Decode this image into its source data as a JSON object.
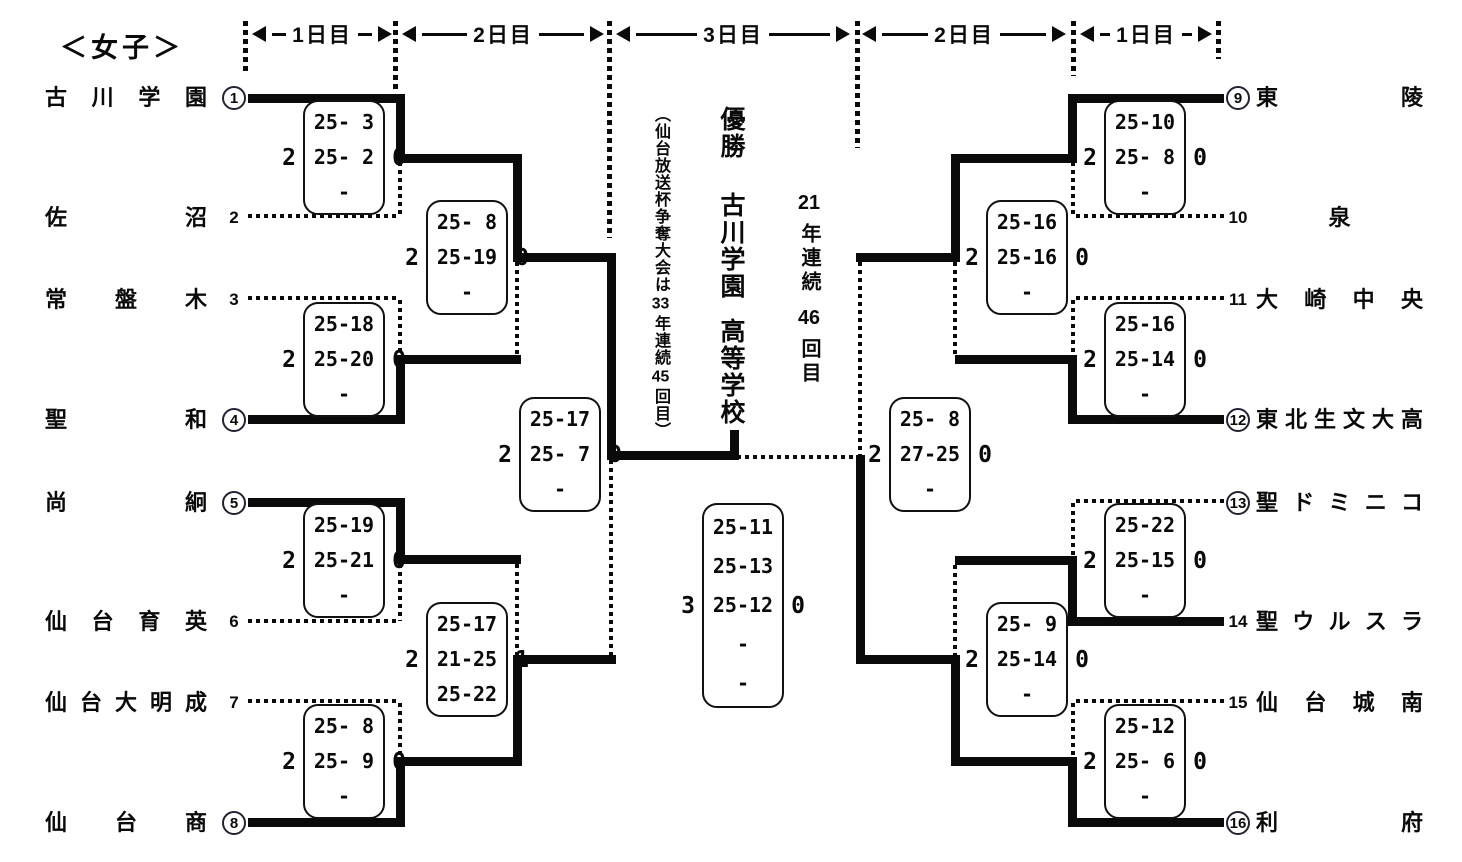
{
  "title": "＜女子＞",
  "headers": [
    "1日目",
    "2日目",
    "3日目",
    "2日目",
    "1日目"
  ],
  "teams_left": [
    {
      "seed": "1",
      "circled": true,
      "name": "古川学園"
    },
    {
      "seed": "2",
      "circled": false,
      "name": "佐沼"
    },
    {
      "seed": "3",
      "circled": false,
      "name": "常盤木"
    },
    {
      "seed": "4",
      "circled": true,
      "name": "聖和"
    },
    {
      "seed": "5",
      "circled": true,
      "name": "尚絅"
    },
    {
      "seed": "6",
      "circled": false,
      "name": "仙台育英"
    },
    {
      "seed": "7",
      "circled": false,
      "name": "仙台大明成"
    },
    {
      "seed": "8",
      "circled": true,
      "name": "仙台商"
    }
  ],
  "teams_right": [
    {
      "seed": "9",
      "circled": true,
      "name": "東陵"
    },
    {
      "seed": "10",
      "circled": false,
      "name": "泉"
    },
    {
      "seed": "11",
      "circled": false,
      "name": "大崎中央"
    },
    {
      "seed": "12",
      "circled": true,
      "name": "東北生文大高"
    },
    {
      "seed": "13",
      "circled": true,
      "name": "聖ドミニコ"
    },
    {
      "seed": "14",
      "circled": false,
      "name": "聖ウルスラ"
    },
    {
      "seed": "15",
      "circled": false,
      "name": "仙台城南"
    },
    {
      "seed": "16",
      "circled": true,
      "name": "利府"
    }
  ],
  "scores": {
    "r1_left": [
      {
        "w": "2",
        "l": "0",
        "sets": [
          "25- 3",
          "25- 2",
          "-"
        ]
      },
      {
        "w": "2",
        "l": "0",
        "sets": [
          "25-18",
          "25-20",
          "-"
        ]
      },
      {
        "w": "2",
        "l": "0",
        "sets": [
          "25-19",
          "25-21",
          "-"
        ]
      },
      {
        "w": "2",
        "l": "0",
        "sets": [
          "25- 8",
          "25- 9",
          "-"
        ]
      }
    ],
    "d2_left": [
      {
        "w": "2",
        "l": "0",
        "sets": [
          "25- 8",
          "25-19",
          "-"
        ]
      },
      {
        "w": "2",
        "l": "1",
        "sets": [
          "25-17",
          "21-25",
          "25-22"
        ]
      }
    ],
    "sf_left": {
      "w": "2",
      "l": "0",
      "sets": [
        "25-17",
        "25- 7",
        "-"
      ]
    },
    "final": {
      "w": "3",
      "l": "0",
      "sets": [
        "25-11",
        "25-13",
        "25-12",
        "-",
        "-"
      ]
    },
    "sf_right": {
      "w": "2",
      "l": "0",
      "sets": [
        "25- 8",
        "27-25",
        "-"
      ]
    },
    "d2_right": [
      {
        "w": "2",
        "l": "0",
        "sets": [
          "25-16",
          "25-16",
          "-"
        ]
      },
      {
        "w": "2",
        "l": "0",
        "sets": [
          "25- 9",
          "25-14",
          "-"
        ]
      }
    ],
    "r1_right": [
      {
        "w": "2",
        "l": "0",
        "sets": [
          "25-10",
          "25- 8",
          "-"
        ]
      },
      {
        "w": "2",
        "l": "0",
        "sets": [
          "25-16",
          "25-14",
          "-"
        ]
      },
      {
        "w": "2",
        "l": "0",
        "sets": [
          "25-22",
          "25-15",
          "-"
        ]
      },
      {
        "w": "2",
        "l": "0",
        "sets": [
          "25-12",
          "25- 6",
          "-"
        ]
      }
    ]
  },
  "center": {
    "note_parts": [
      "（仙台放送杯争奪大会は",
      "33",
      "年連続",
      "45",
      "回目）"
    ],
    "champion_label": "優勝",
    "champion_name": "古川学園",
    "champion_suffix": "高等学校",
    "streak_parts": [
      "21",
      "年連続",
      "46",
      "回目"
    ]
  }
}
